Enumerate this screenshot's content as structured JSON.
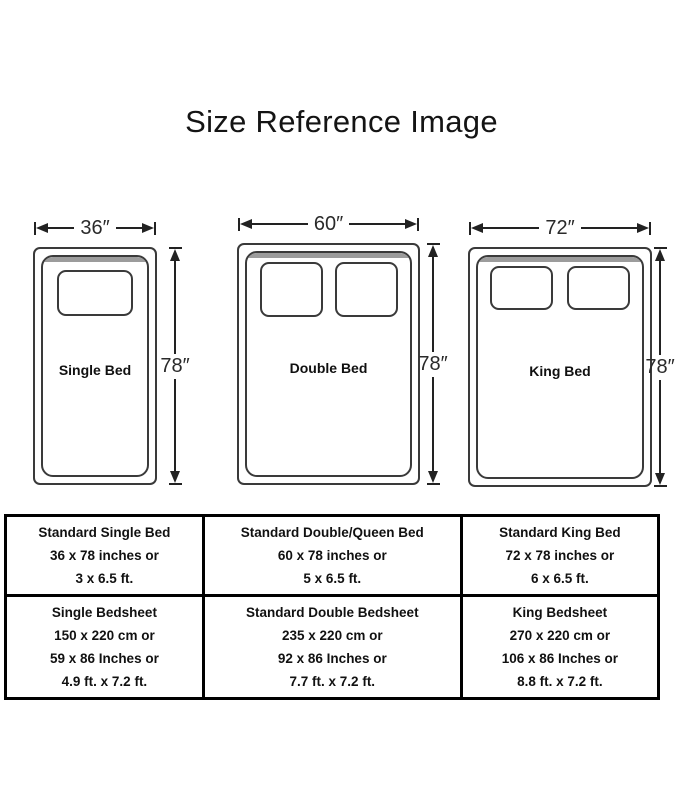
{
  "title": "Size Reference Image",
  "beds": [
    {
      "name": "Single Bed",
      "width_label": "36″",
      "height_label": "78″",
      "pillow_count": 1
    },
    {
      "name": "Double Bed",
      "width_label": "60″",
      "height_label": "78″",
      "pillow_count": 2
    },
    {
      "name": "King Bed",
      "width_label": "72″",
      "height_label": "78″",
      "pillow_count": 2
    }
  ],
  "table": {
    "rows": [
      [
        {
          "lines": [
            "Standard Single Bed",
            "36 x 78 inches or",
            "3 x 6.5 ft."
          ]
        },
        {
          "lines": [
            "Standard Double/Queen Bed",
            "60 x 78 inches or",
            "5 x 6.5 ft."
          ]
        },
        {
          "lines": [
            "Standard King Bed",
            "72 x 78 inches or",
            "6 x 6.5 ft."
          ]
        }
      ],
      [
        {
          "lines": [
            "Single Bedsheet",
            "150 x 220 cm or",
            "59 x 86 Inches or",
            "4.9 ft. x 7.2 ft."
          ]
        },
        {
          "lines": [
            "Standard Double Bedsheet",
            "235 x 220 cm or",
            "92 x 86 Inches or",
            "7.7 ft. x 7.2 ft."
          ]
        },
        {
          "lines": [
            "King Bedsheet",
            "270 x 220 cm or",
            "106 x 86 Inches or",
            "8.8 ft. x 7.2 ft."
          ]
        }
      ]
    ]
  },
  "colors": {
    "ink": "#222222",
    "table_border": "#000000",
    "sheet_fold": "#9c9c9c",
    "background": "#ffffff"
  }
}
